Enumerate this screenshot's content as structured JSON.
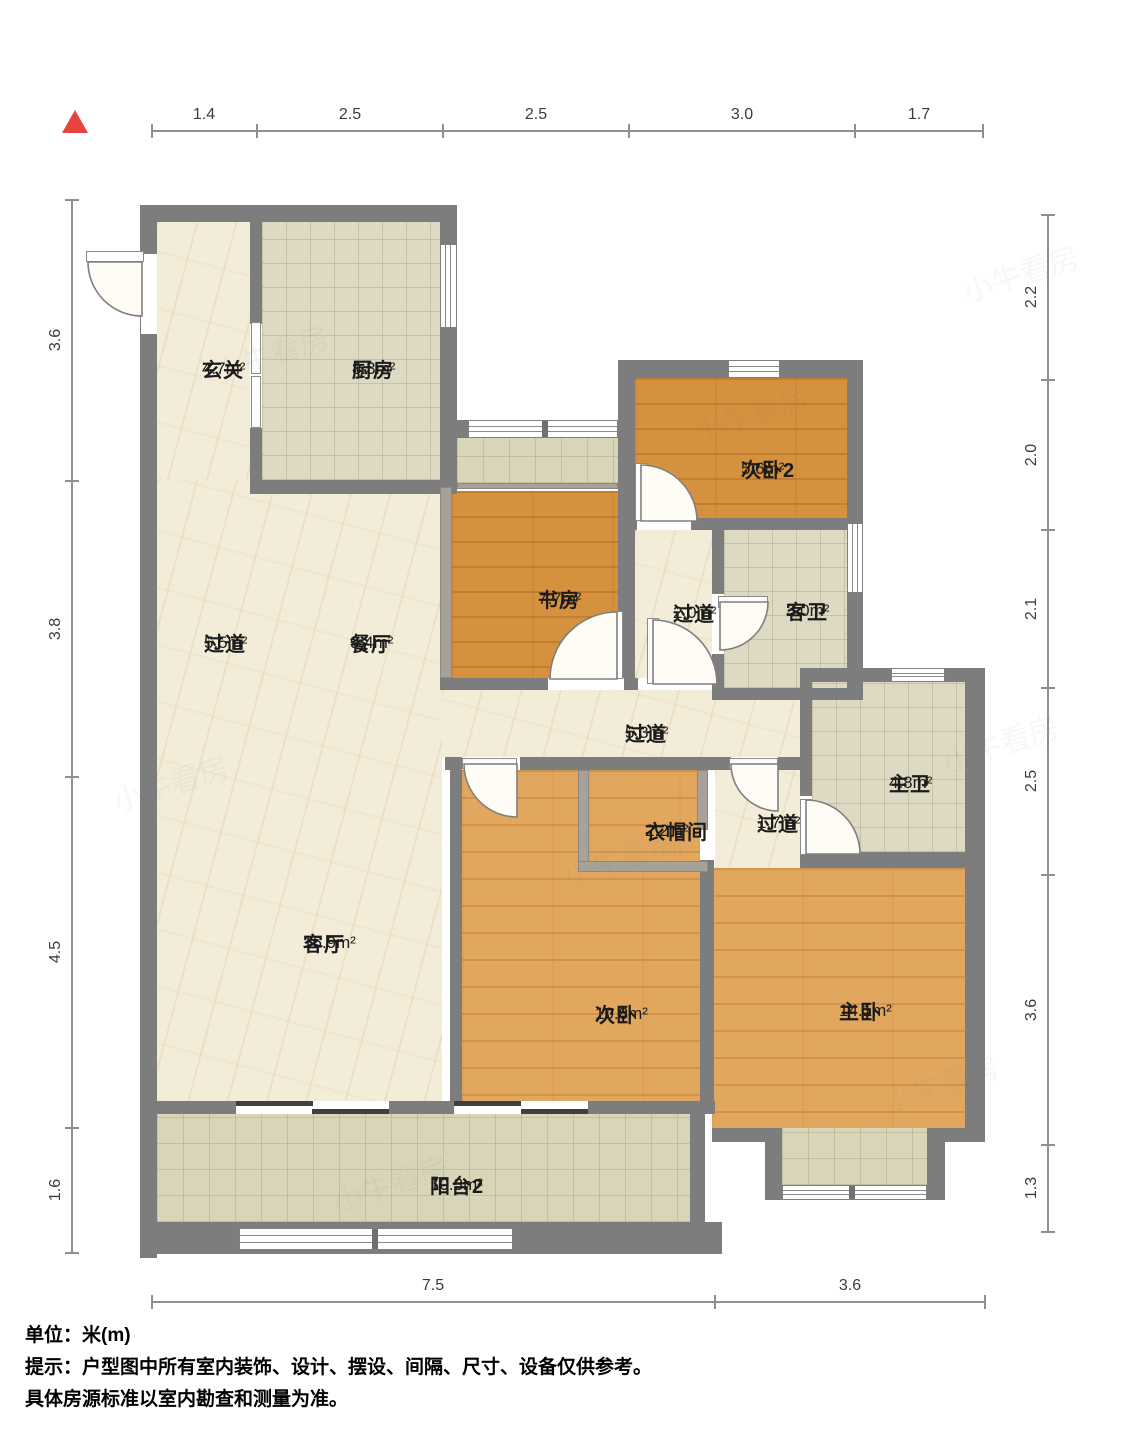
{
  "notes": {
    "line1": "单位：米(m)",
    "line2": "提示：户型图中所有室内装饰、设计、摆设、间隔、尺寸、设备仅供参考。",
    "line3": "具体房源标准以室内勘查和测量为准。"
  },
  "plan": {
    "colors": {
      "wall": "#7d7d7d",
      "marble": "#f3ecd8",
      "tile": "#ded9c2",
      "balcony_tile": "#d9d5b8",
      "wood_light": "#e2a75e",
      "wood_dark": "#d6913f",
      "compass_red": "#e8433c"
    },
    "compass": {
      "x": 62,
      "y": 110
    },
    "rooms": [
      {
        "id": "entry-hall",
        "name": "玄关",
        "area": "4.7m²",
        "cx": 202,
        "cy": 358
      },
      {
        "id": "kitchen",
        "name": "厨房",
        "area": "8.3m²",
        "cx": 352,
        "cy": 358
      },
      {
        "id": "bedroom2",
        "name": "次卧2",
        "area": "5.6m²",
        "cx": 741,
        "cy": 458
      },
      {
        "id": "study",
        "name": "书房",
        "area": "7.7m²",
        "cx": 538,
        "cy": 588
      },
      {
        "id": "hallway-2_0",
        "name": "过道",
        "area": "2.0m²",
        "cx": 673,
        "cy": 602
      },
      {
        "id": "guest-bath",
        "name": "客卫",
        "area": "3.0m²",
        "cx": 786,
        "cy": 600
      },
      {
        "id": "hallway-5_5",
        "name": "过道",
        "area": "5.5m²",
        "cx": 204,
        "cy": 632
      },
      {
        "id": "dining",
        "name": "餐厅",
        "area": "9.4m²",
        "cx": 350,
        "cy": 632
      },
      {
        "id": "hallway-5_3",
        "name": "过道",
        "area": "5.3m²",
        "cx": 625,
        "cy": 722
      },
      {
        "id": "master-bath",
        "name": "主卫",
        "area": "4.8m²",
        "cx": 889,
        "cy": 772
      },
      {
        "id": "cloakroom",
        "name": "衣帽间",
        "area": "2.2m²",
        "cx": 645,
        "cy": 820
      },
      {
        "id": "hallway-1_7",
        "name": "过道",
        "area": "1.7m²",
        "cx": 757,
        "cy": 812
      },
      {
        "id": "living",
        "name": "客厅",
        "area": "16.9m²",
        "cx": 303,
        "cy": 932
      },
      {
        "id": "bedroom",
        "name": "次卧",
        "area": "10.8m²",
        "cx": 595,
        "cy": 1003
      },
      {
        "id": "master-bedroom",
        "name": "主卧",
        "area": "14.1m²",
        "cx": 839,
        "cy": 1000
      },
      {
        "id": "balcony2",
        "name": "阳台2",
        "area": "10.3m²",
        "cx": 430,
        "cy": 1174
      }
    ],
    "floors": [
      {
        "id": "entry-hall",
        "type": "marble",
        "rect": [
          157,
          222,
          93,
          258
        ]
      },
      {
        "id": "kitchen",
        "type": "tile",
        "rect": [
          262,
          222,
          178,
          258
        ]
      },
      {
        "id": "dining-living",
        "type": "marble",
        "rect": [
          157,
          480,
          285,
          621
        ]
      },
      {
        "id": "hallway-5_3",
        "type": "marble",
        "rect": [
          442,
          690,
          358,
          67
        ]
      },
      {
        "id": "hallway-2_0",
        "type": "marble",
        "rect": [
          635,
          530,
          77,
          148
        ]
      },
      {
        "id": "hallway-1_7",
        "type": "marble",
        "rect": [
          715,
          770,
          85,
          98
        ]
      },
      {
        "id": "equip-platform",
        "type": "btile",
        "rect": [
          457,
          438,
          161,
          45
        ]
      },
      {
        "id": "study",
        "type": "woodB",
        "rect": [
          452,
          491,
          166,
          187
        ]
      },
      {
        "id": "bedroom2",
        "type": "woodB",
        "rect": [
          635,
          378,
          212,
          140
        ]
      },
      {
        "id": "guest-bath",
        "type": "tile",
        "rect": [
          724,
          530,
          123,
          158
        ]
      },
      {
        "id": "master-bath",
        "type": "tile",
        "rect": [
          812,
          682,
          153,
          170
        ]
      },
      {
        "id": "bedroom",
        "type": "woodA",
        "rect": [
          462,
          770,
          238,
          331
        ]
      },
      {
        "id": "cloakroom",
        "type": "woodA",
        "rect": [
          589,
          770,
          108,
          91
        ]
      },
      {
        "id": "master-bedroom",
        "type": "woodA",
        "rect": [
          712,
          868,
          253,
          260
        ]
      },
      {
        "id": "balcony2",
        "type": "btile",
        "rect": [
          157,
          1114,
          533,
          108
        ]
      },
      {
        "id": "master-balcony",
        "type": "btile",
        "rect": [
          782,
          1128,
          145,
          57
        ]
      }
    ],
    "walls": [
      [
        140,
        205,
        317,
        17
      ],
      [
        140,
        205,
        17,
        1053
      ],
      [
        440,
        205,
        17,
        282
      ],
      [
        250,
        222,
        12,
        102
      ],
      [
        250,
        428,
        12,
        52
      ],
      [
        250,
        480,
        207,
        14
      ],
      [
        457,
        420,
        11,
        18
      ],
      [
        618,
        360,
        17,
        330
      ],
      [
        618,
        360,
        245,
        18
      ],
      [
        847,
        360,
        16,
        340
      ],
      [
        635,
        518,
        212,
        12
      ],
      [
        712,
        530,
        12,
        160
      ],
      [
        440,
        678,
        198,
        12
      ],
      [
        712,
        688,
        151,
        12
      ],
      [
        445,
        757,
        17,
        13
      ],
      [
        520,
        757,
        211,
        13
      ],
      [
        778,
        757,
        22,
        13
      ],
      [
        450,
        757,
        12,
        357
      ],
      [
        800,
        668,
        183,
        14
      ],
      [
        800,
        682,
        12,
        114
      ],
      [
        965,
        668,
        20,
        474
      ],
      [
        800,
        852,
        165,
        16
      ],
      [
        700,
        860,
        14,
        254
      ],
      [
        157,
        1101,
        79,
        13
      ],
      [
        389,
        1101,
        65,
        13
      ],
      [
        588,
        1101,
        127,
        13
      ],
      [
        690,
        1114,
        15,
        108
      ],
      [
        140,
        1222,
        582,
        32
      ],
      [
        712,
        1128,
        53,
        14
      ],
      [
        927,
        1128,
        38,
        14
      ],
      [
        765,
        1128,
        17,
        72
      ],
      [
        927,
        1142,
        18,
        58
      ]
    ],
    "partitions": [
      [
        440,
        487,
        12,
        191
      ],
      [
        457,
        483,
        161,
        6
      ],
      [
        578,
        770,
        11,
        102
      ],
      [
        578,
        861,
        130,
        11
      ],
      [
        697,
        770,
        11,
        60
      ]
    ],
    "openings": [
      [
        141,
        254,
        16,
        80
      ],
      [
        637,
        518,
        54,
        12
      ],
      [
        712,
        594,
        12,
        60
      ],
      [
        548,
        678,
        76,
        12
      ],
      [
        800,
        796,
        12,
        56
      ]
    ],
    "windows": [
      {
        "rect": [
          440,
          244,
          17,
          84
        ],
        "o": "v"
      },
      {
        "rect": [
          468,
          420,
          150,
          18
        ],
        "o": "h",
        "m": [
          73
        ]
      },
      {
        "rect": [
          728,
          360,
          52,
          18
        ],
        "o": "h"
      },
      {
        "rect": [
          847,
          523,
          16,
          70
        ],
        "o": "v"
      },
      {
        "rect": [
          891,
          668,
          54,
          14
        ],
        "o": "h"
      },
      {
        "rect": [
          239,
          1228,
          274,
          22
        ],
        "o": "h",
        "m": [
          132
        ]
      },
      {
        "rect": [
          782,
          1185,
          145,
          15
        ],
        "o": "h",
        "m": [
          66
        ]
      }
    ],
    "slider_panels": [
      [
        251,
        322,
        10,
        52
      ],
      [
        251,
        376,
        10,
        52
      ]
    ],
    "slider_bars": [
      [
        236,
        1101,
        153,
        13
      ],
      [
        454,
        1101,
        134,
        13
      ]
    ],
    "slider_tracks": [
      [
        236,
        1101,
        77,
        5
      ],
      [
        312,
        1109,
        77,
        5
      ],
      [
        454,
        1101,
        67,
        5
      ],
      [
        521,
        1109,
        67,
        5
      ]
    ],
    "door_leaves": [
      [
        86,
        251,
        58,
        11
      ],
      [
        611,
        611,
        12,
        68
      ],
      [
        647,
        618,
        12,
        66
      ],
      [
        718,
        596,
        50,
        12
      ],
      [
        462,
        758,
        55,
        11
      ],
      [
        729,
        758,
        49,
        11
      ],
      [
        800,
        799,
        12,
        56
      ],
      [
        806,
        842,
        54,
        12
      ],
      [
        635,
        463,
        12,
        58
      ]
    ],
    "door_swings": [
      {
        "id": "entry-door",
        "d": "M142,262 L88,262 A54,54 0 0 0 142,316 Z"
      },
      {
        "id": "study-door",
        "d": "M617,679 L617,612 A67,67 0 0 0 550,679 Z"
      },
      {
        "id": "hallway2-door",
        "d": "M653,684 L653,620 A64,64 0 0 1 717,684 Z"
      },
      {
        "id": "guest-bath-door",
        "d": "M720,602 L768,602 A48,48 0 0 1 720,650 Z"
      },
      {
        "id": "bedroom-door",
        "d": "M517,764 L464,764 A53,53 0 0 0 517,817 Z"
      },
      {
        "id": "hallway17-door",
        "d": "M778,764 L731,764 A47,47 0 0 0 778,811 Z"
      },
      {
        "id": "master-bath-door",
        "d": "M806,854 L806,800 A54,54 0 0 1 860,854 Z"
      },
      {
        "id": "bedroom2-door",
        "d": "M641,521 L641,465 A56,56 0 0 1 697,521 Z"
      }
    ],
    "dims": {
      "top": {
        "y": 131,
        "x1": 152,
        "x2": 983,
        "ticks": [
          152,
          257,
          443,
          629,
          855,
          983
        ],
        "labels": [
          {
            "t": "1.4",
            "x": 204
          },
          {
            "t": "2.5",
            "x": 350
          },
          {
            "t": "2.5",
            "x": 536
          },
          {
            "t": "3.0",
            "x": 742
          },
          {
            "t": "1.7",
            "x": 919
          }
        ]
      },
      "bottom": {
        "y": 1302,
        "x1": 152,
        "x2": 985,
        "ticks": [
          152,
          715,
          985
        ],
        "labels": [
          {
            "t": "7.5",
            "x": 433
          },
          {
            "t": "3.6",
            "x": 850
          }
        ]
      },
      "left": {
        "x": 72,
        "y1": 200,
        "y2": 1253,
        "ticks": [
          200,
          481,
          777,
          1128,
          1253
        ],
        "labels": [
          {
            "t": "3.6",
            "y": 340
          },
          {
            "t": "3.8",
            "y": 629
          },
          {
            "t": "4.5",
            "y": 952
          },
          {
            "t": "1.6",
            "y": 1190
          }
        ]
      },
      "right": {
        "x": 1048,
        "y1": 215,
        "y2": 1232,
        "ticks": [
          215,
          380,
          530,
          688,
          875,
          1145,
          1232
        ],
        "labels": [
          {
            "t": "2.2",
            "y": 297
          },
          {
            "t": "2.0",
            "y": 455
          },
          {
            "t": "2.1",
            "y": 609
          },
          {
            "t": "2.5",
            "y": 781
          },
          {
            "t": "3.6",
            "y": 1010
          },
          {
            "t": "1.3",
            "y": 1188
          }
        ]
      }
    },
    "watermarks": [
      {
        "t": "小牛看房",
        "x": 210,
        "y": 330
      },
      {
        "t": "小牛看房",
        "x": 690,
        "y": 390
      },
      {
        "t": "小牛看房",
        "x": 110,
        "y": 760
      },
      {
        "t": "小牛看房",
        "x": 560,
        "y": 835
      },
      {
        "t": "小牛看房",
        "x": 940,
        "y": 720
      },
      {
        "t": "小牛看房",
        "x": 330,
        "y": 1160
      },
      {
        "t": "小牛看房",
        "x": 880,
        "y": 1060
      },
      {
        "t": "小牛看房",
        "x": 960,
        "y": 250
      }
    ]
  }
}
